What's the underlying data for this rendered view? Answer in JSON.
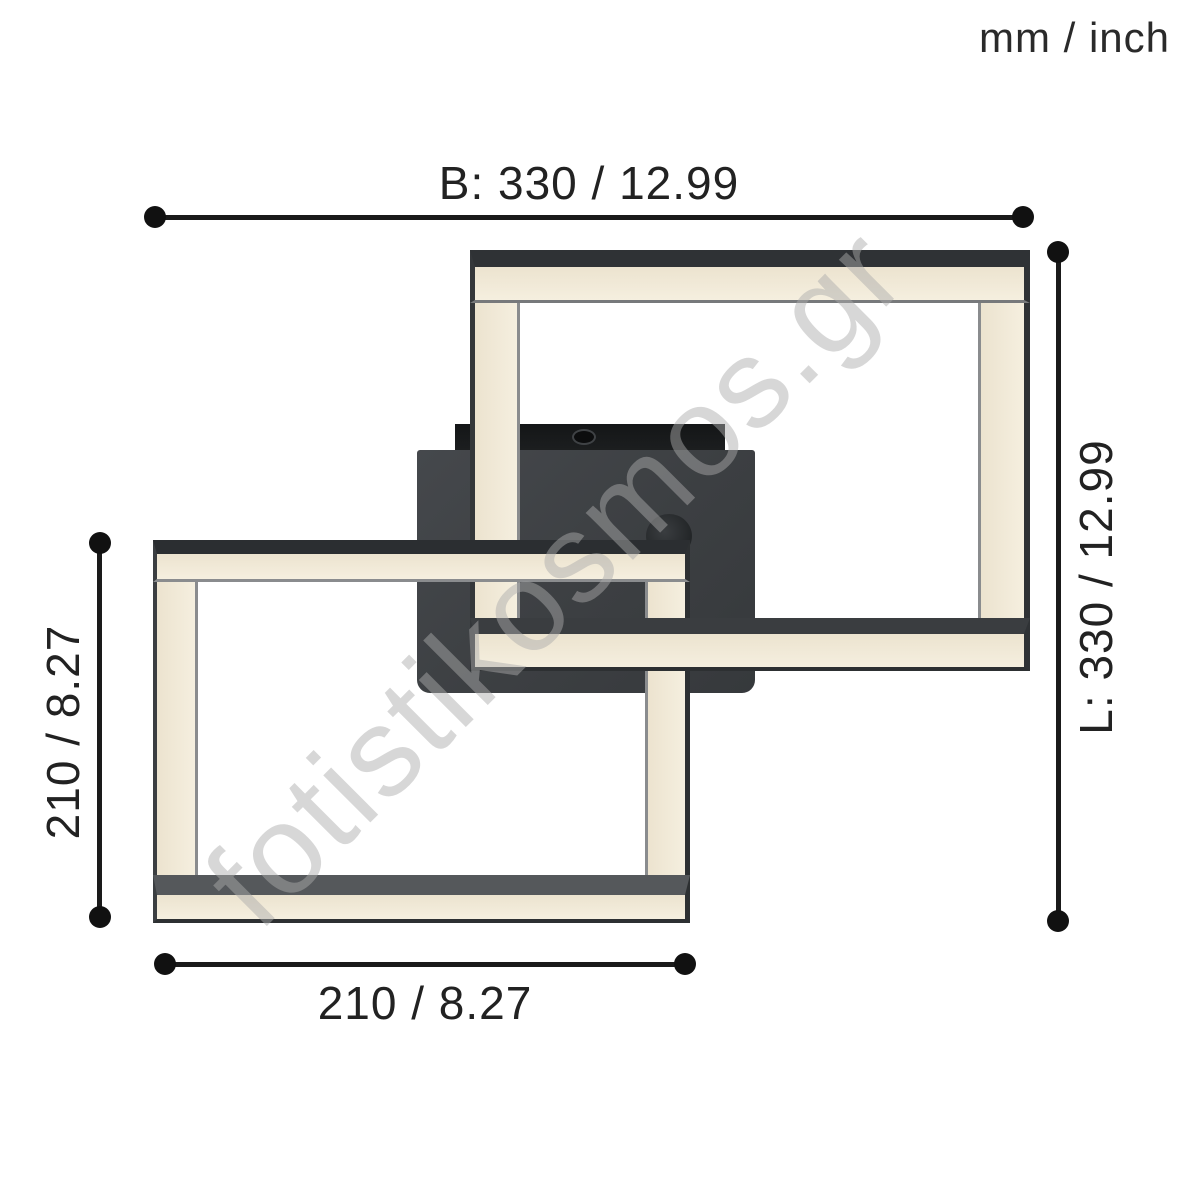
{
  "units_label": "mm / inch",
  "dimensions": {
    "total_width": "B: 330 / 12.99",
    "total_length": "L: 330 / 12.99",
    "inner_square_height": "210 / 8.27",
    "inner_square_width": "210 / 8.27"
  },
  "watermark": "fotistikosmos.gr",
  "colors": {
    "frame_metal": "#34373a",
    "led_diffuser": "#f1e9d6",
    "canopy": "#3e4144",
    "rear_plate": "#1c1e20",
    "dimension_ink": "#1a1a1a",
    "background": "#ffffff"
  }
}
